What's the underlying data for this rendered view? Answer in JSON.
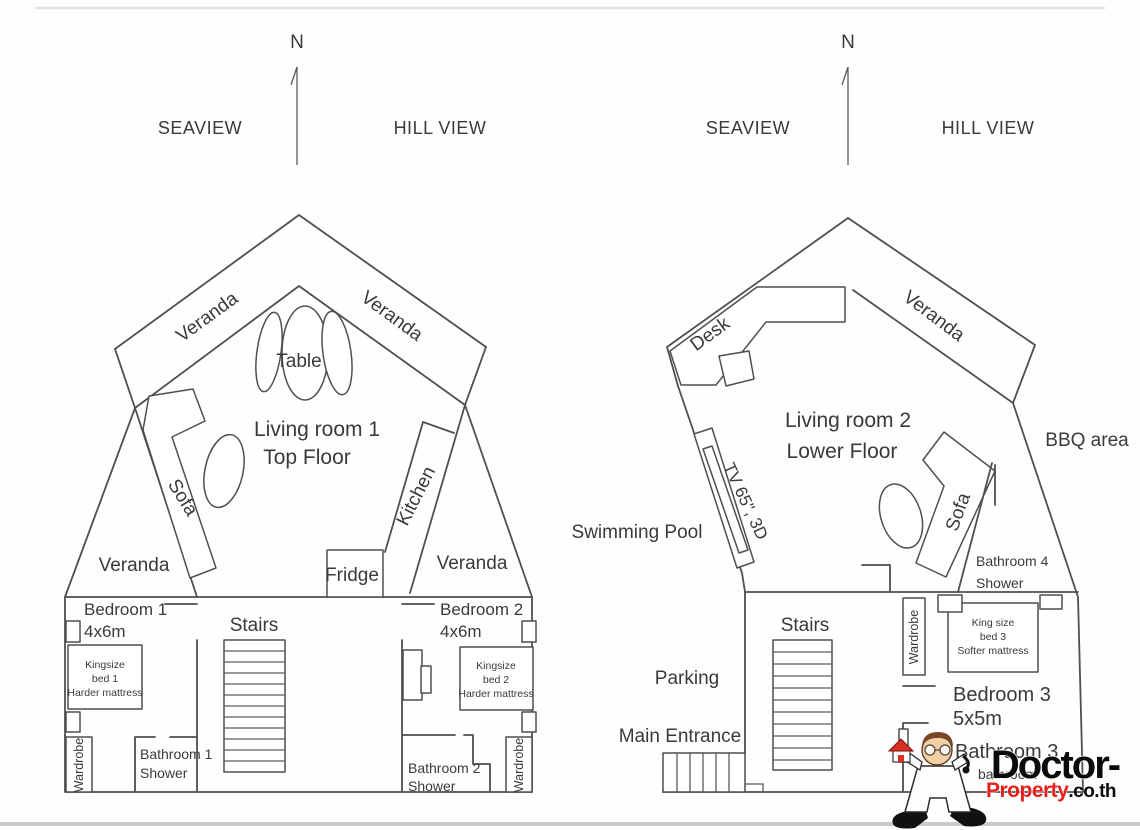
{
  "colors": {
    "wall_line": "#4f4f4f",
    "text": "#3a3a3a",
    "logo_black": "#0b0b0b",
    "logo_red": "#e3201b",
    "house_red": "#d93025",
    "border_line_top": "#e0e3e4",
    "border_line_bottom": "#c7ccd0"
  },
  "compass": {
    "north": "N",
    "west_label": "SEAVIEW",
    "east_label": "HILL VIEW"
  },
  "top_floor": {
    "title_line1": "Living room 1",
    "title_line2": "Top Floor",
    "veranda_roof_left": "Veranda",
    "veranda_roof_right": "Veranda",
    "table": "Table",
    "sofa": "Sofa",
    "kitchen": "Kitchen",
    "fridge": "Fridge",
    "veranda_wing_left": "Veranda",
    "veranda_wing_right": "Veranda",
    "stairs": "Stairs",
    "bedroom1": {
      "name": "Bedroom 1",
      "size": "4x6m",
      "bed_line1": "Kingsize",
      "bed_line2": "bed 1",
      "bed_line3": "Harder mattress",
      "wardrobe": "Wardrobe",
      "bathroom_line1": "Bathroom 1",
      "bathroom_line2": "Shower"
    },
    "bedroom2": {
      "name": "Bedroom 2",
      "size": "4x6m",
      "bed_line1": "Kingsize",
      "bed_line2": "bed 2",
      "bed_line3": "Harder mattress",
      "wardrobe": "Wardrobe",
      "bathroom_line1": "Bathroom 2",
      "bathroom_line2": "Shower"
    }
  },
  "lower_floor": {
    "title_line1": "Living room 2",
    "title_line2": "Lower Floor",
    "desk": "Desk",
    "veranda": "Veranda",
    "bbq_area": "BBQ area",
    "swimming_pool": "Swimming Pool",
    "tv": "TV 65\", 3D",
    "sofa": "Sofa",
    "bathroom4_line1": "Bathroom 4",
    "bathroom4_line2": "Shower",
    "stairs": "Stairs",
    "parking": "Parking",
    "main_entrance": "Main Entrance",
    "wardrobe": "Wardrobe",
    "bed3_line1": "King size",
    "bed3_line2": "bed 3",
    "bed3_line3": "Softer mattress",
    "bedroom3_name": "Bedroom 3",
    "bedroom3_size": "5x5m",
    "bathroom3_line1": "Bathroom 3",
    "bathroom3_line2": "bathroom"
  },
  "watermark": {
    "brand_black": "Doctor-",
    "brand_red": "Property",
    "brand_suffix": ".co.th"
  }
}
